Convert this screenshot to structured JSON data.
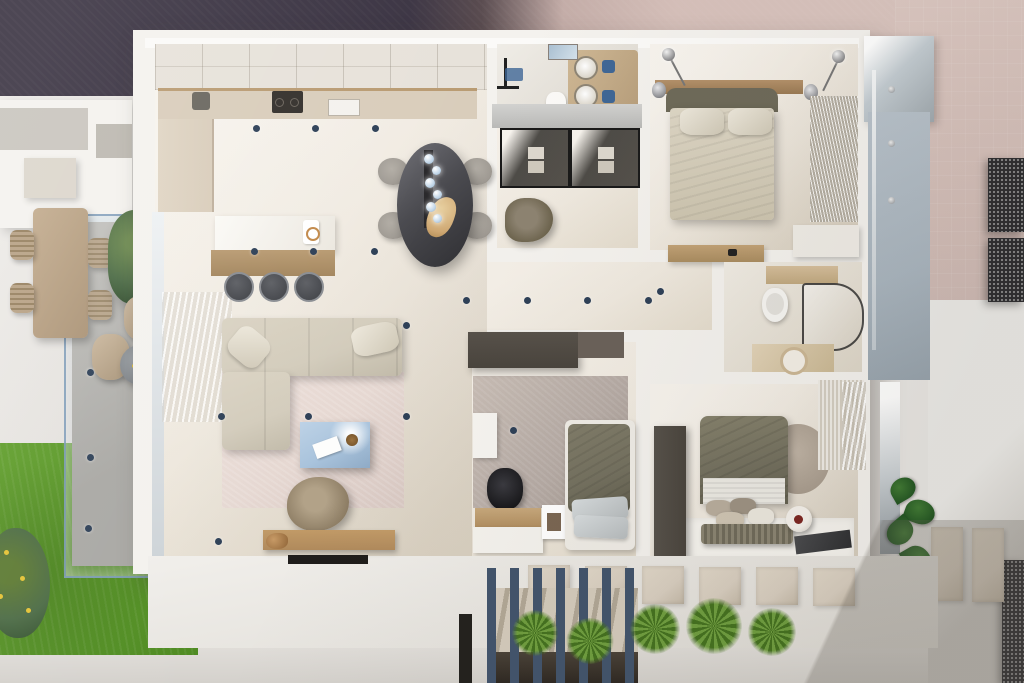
{
  "scene": {
    "kind": "3d-apartment-floor-plan-render",
    "view": "top-down",
    "rooms": [
      {
        "name": "kitchen",
        "furniture": [
          "l-shaped-counter",
          "cooktop",
          "sink",
          "island-with-wood-base",
          "three-bar-stools",
          "ceiling-grid"
        ]
      },
      {
        "name": "dining-area",
        "furniture": [
          "dark-oval-table",
          "four-gray-chairs",
          "glass-globe-chandelier",
          "dried-flower-centerpiece"
        ]
      },
      {
        "name": "living-room",
        "furniture": [
          "beige-l-sectional-sofa",
          "pink-beige-rug",
          "blue-glass-coffee-table",
          "magazine",
          "triangular-lounge-chair",
          "wood-tv-console",
          "wall-tv",
          "dog",
          "sheer-curtains"
        ]
      },
      {
        "name": "bathroom-1",
        "furniture": [
          "shower-with-blue-mat",
          "toilet",
          "double-round-basin-vanity",
          "blue-towels",
          "skylight"
        ]
      },
      {
        "name": "walk-in-closet",
        "furniture": [
          "glass-front-wardrobe",
          "curved-chair"
        ]
      },
      {
        "name": "master-bedroom",
        "furniture": [
          "double-bed-beige-duvet",
          "olive-headboard",
          "two-pendant-lamps",
          "wood-headboard-shelf",
          "hanging-clothes-wardrobe",
          "white-dresser"
        ]
      },
      {
        "name": "hallway",
        "furniture": [
          "wood-console"
        ]
      },
      {
        "name": "bathroom-2",
        "furniture": [
          "wall-hung-toilet",
          "curved-glass-shower",
          "stone-basin-vanity",
          "wall-mirror",
          "wood-shelf"
        ]
      },
      {
        "name": "bedroom-2",
        "furniture": [
          "dark-wardrobe",
          "gray-taupe-rug",
          "wall-shelf",
          "wood-desk",
          "black-office-chair",
          "white-cabinet",
          "photo-frame",
          "single-bed-olive-duvet",
          "stacked-pillows"
        ]
      },
      {
        "name": "bedroom-3",
        "furniture": [
          "double-bed-olive-duvet",
          "pillow-cluster",
          "ribbed-bench",
          "round-rug",
          "dark-wardrobe",
          "decor-sphere",
          "dark-tray",
          "blinds-window",
          "white-floor-rug"
        ]
      }
    ],
    "exterior": [
      {
        "name": "left-patio",
        "items": [
          "wood-dining-table",
          "wicker-chairs",
          "tree",
          "two-lounge-chairs",
          "round-gray-table-with-yellow-flowers",
          "glass-railed-gray-paving"
        ]
      },
      {
        "name": "garden",
        "items": [
          "green-lawn",
          "flowering-shrub"
        ]
      },
      {
        "name": "neighbor-building",
        "items": [
          "white-roof-volumes"
        ]
      },
      {
        "name": "right-balcony",
        "items": [
          "bluish-floor",
          "glass-balustrade",
          "perforated-metal-screens",
          "potted-plant",
          "stone-wall-tiles",
          "wall-mirror-glass"
        ]
      },
      {
        "name": "front-terrace",
        "items": [
          "stair-with-blue-slat-screen",
          "handrail",
          "five-agave-plants",
          "stone-slabs"
        ]
      },
      {
        "name": "surroundings",
        "items": [
          "dark-asphalt-top-left",
          "rose-paving-top-right",
          "light-walkways",
          "sun-shadows"
        ]
      }
    ],
    "lights": {
      "ceiling_spotlights": [
        [
          253,
          125
        ],
        [
          312,
          125
        ],
        [
          372,
          125
        ],
        [
          251,
          248
        ],
        [
          310,
          248
        ],
        [
          371,
          248
        ],
        [
          463,
          297
        ],
        [
          524,
          297
        ],
        [
          584,
          297
        ],
        [
          645,
          297
        ],
        [
          403,
          322
        ],
        [
          305,
          413
        ],
        [
          403,
          413
        ],
        [
          218,
          413
        ],
        [
          215,
          538
        ],
        [
          87,
          369
        ],
        [
          87,
          454
        ],
        [
          85,
          525
        ],
        [
          510,
          427
        ],
        [
          657,
          288
        ]
      ],
      "glass_bolts": [
        [
          888,
          86
        ],
        [
          888,
          140
        ],
        [
          888,
          197
        ]
      ]
    },
    "palette": {
      "bgDark": "#393241",
      "bgRose": "#d6c0ba",
      "pavement": "#e9e7e4",
      "lawn": "#5f9d2a",
      "lawnDark": "#4e8a21",
      "treeGreen": "#4c6b45",
      "wall": "#f4f2ee",
      "wallBright": "#fbfaf8",
      "floorCream": "#efe9df",
      "counterBeige": "#d9cdbb",
      "woodLight": "#c2a276",
      "woodMid": "#b99b72",
      "woodTv": "#b08a5c",
      "islandWood": "#b99b72",
      "sofa": "#d3ccbc",
      "rugLiving": "#e6d8d2",
      "rugGray": "#b5aaa4",
      "tableDark": "#4a4a4f",
      "chairGray": "#9f9a93",
      "coffeeBlue": "#a9c3dc",
      "oliveDuvet": "#73705f",
      "bedWhite": "#efece6",
      "wardrobeDark": "#49443d",
      "slatBlue": "#42546c",
      "agave": "#6f9e3f",
      "agaveDark": "#44711f",
      "balconyFloor": "#a9b5bf",
      "tileStone": "#d8cec0",
      "spotNavy": "#2e4057",
      "accentBlueTowel": "#3f6796",
      "skyGlass": "#aac0d2",
      "stairVoid": "#2e2822"
    }
  }
}
